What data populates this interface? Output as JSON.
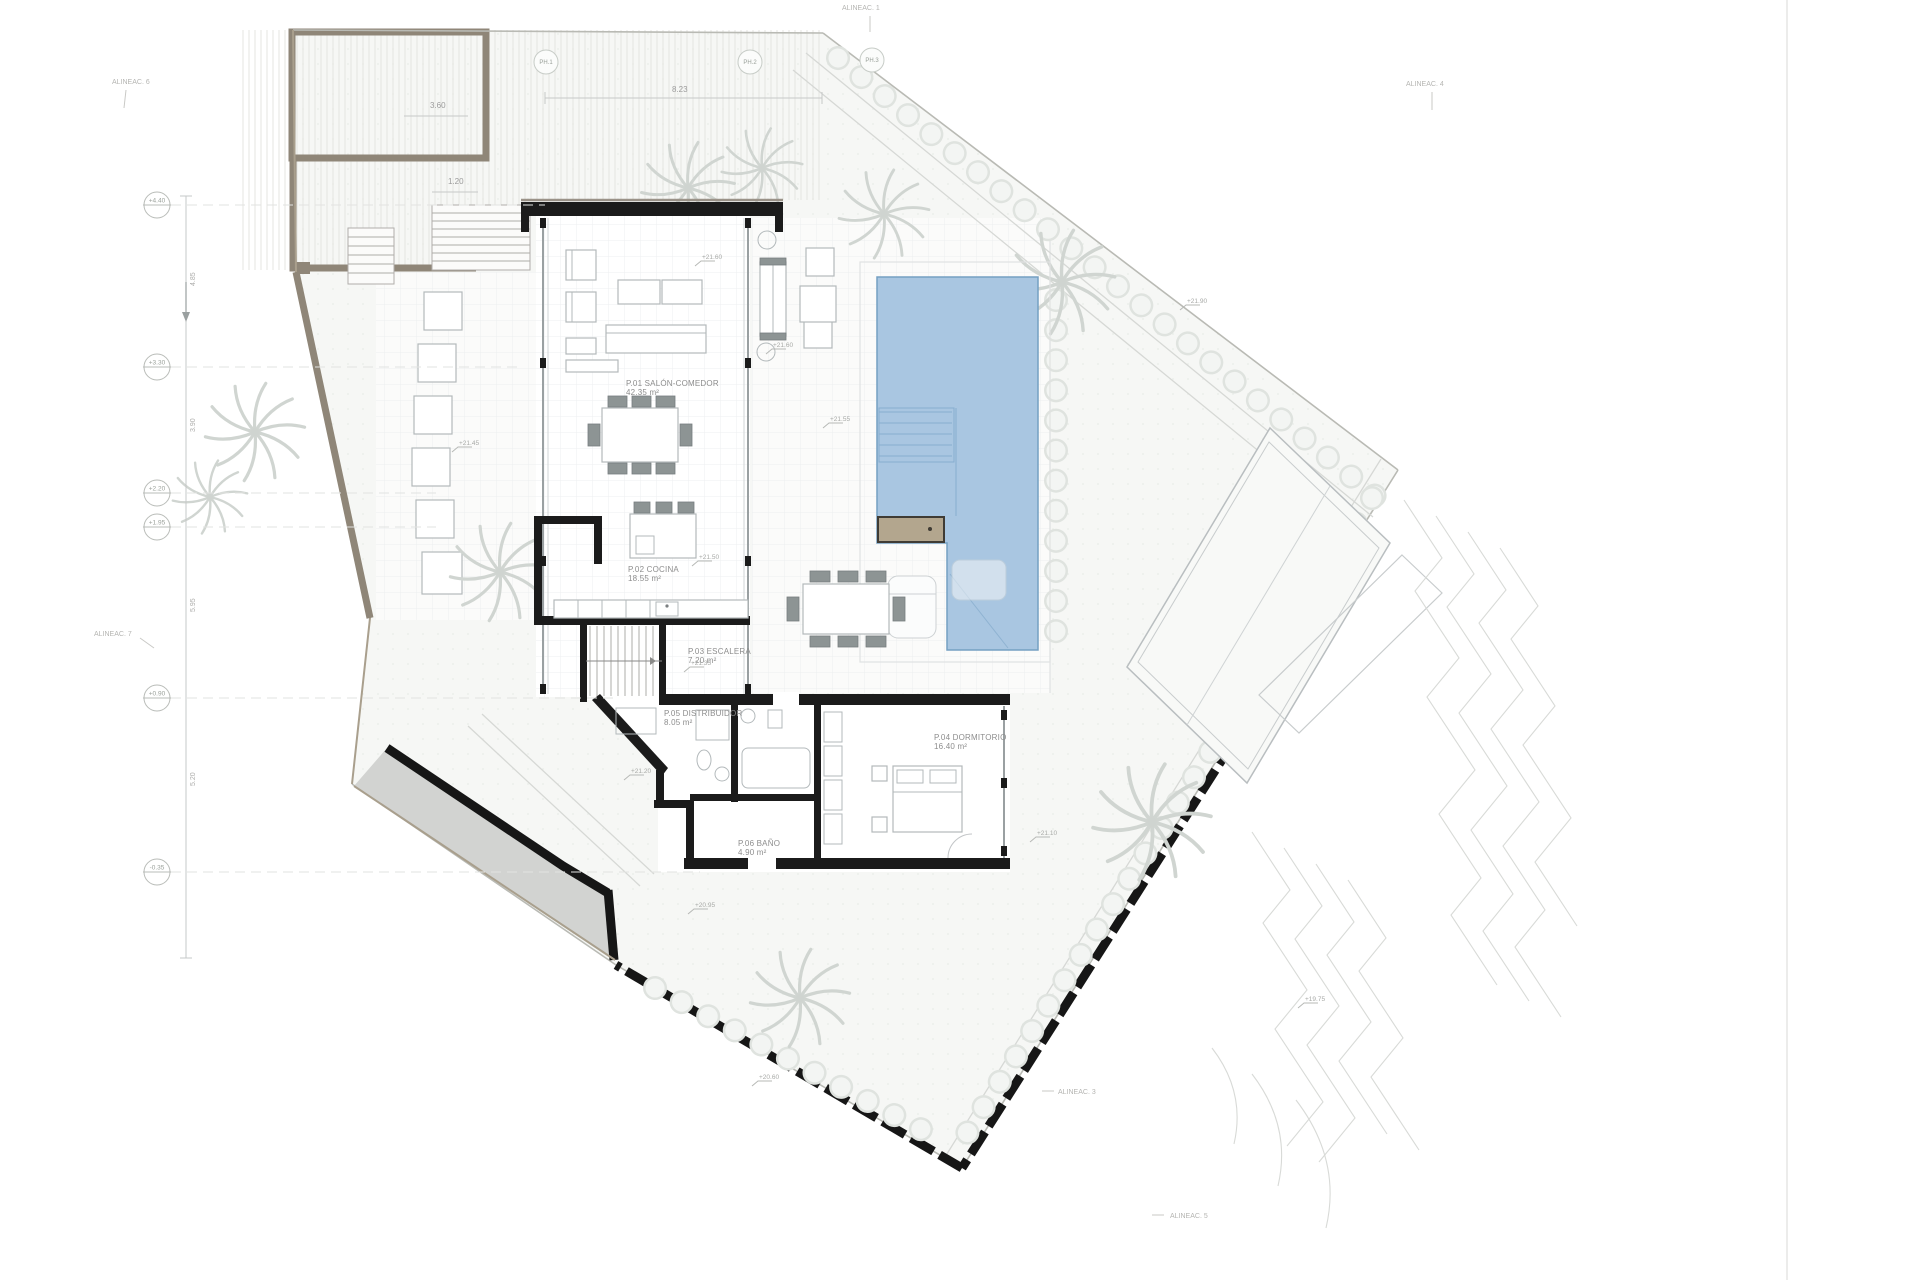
{
  "drawing": {
    "type": "villa ground-floor site plan",
    "sheet_edge_note": ""
  },
  "rooms": [
    {
      "id": "salon",
      "name": "P.01 SALÓN-COMEDOR",
      "area": "42.35 m²",
      "x": 626,
      "y": 386
    },
    {
      "id": "cocina",
      "name": "P.02 COCINA",
      "area": "18.55 m²",
      "x": 628,
      "y": 572
    },
    {
      "id": "escalera",
      "name": "P.03 ESCALERA",
      "area": "7.20 m²",
      "x": 688,
      "y": 654
    },
    {
      "id": "distribuidor",
      "name": "P.05 DISTRIBUIDOR",
      "area": "8.05 m²",
      "x": 664,
      "y": 716
    },
    {
      "id": "bano",
      "name": "P.06 BAÑO",
      "area": "4.90 m²",
      "x": 738,
      "y": 846
    },
    {
      "id": "dormitorio",
      "name": "P.04 DORMITORIO",
      "area": "16.40 m²",
      "x": 934,
      "y": 740
    }
  ],
  "alignment_labels": [
    {
      "text": "ALINEAC. 6",
      "x": 112,
      "y": 84,
      "tick": [
        14,
        6,
        12,
        24
      ]
    },
    {
      "text": "ALINEAC. 1",
      "x": 842,
      "y": 10,
      "tick": [
        28,
        6,
        28,
        22
      ]
    },
    {
      "text": "ALINEAC. 4",
      "x": 1406,
      "y": 86,
      "tick": [
        26,
        6,
        26,
        24
      ]
    },
    {
      "text": "ALINEAC. 7",
      "x": 94,
      "y": 636,
      "tick": [
        46,
        2,
        60,
        12
      ]
    },
    {
      "text": "ALINEAC. 3",
      "x": 1058,
      "y": 1094,
      "tick": [
        -16,
        -3,
        -4,
        -3
      ]
    },
    {
      "text": "ALINEAC. 5",
      "x": 1170,
      "y": 1218,
      "tick": [
        -18,
        -3,
        -6,
        -3
      ]
    }
  ],
  "plant_tags": [
    {
      "text": "PH.1",
      "x": 546,
      "y": 62
    },
    {
      "text": "PH.2",
      "x": 750,
      "y": 62
    },
    {
      "text": "PH.3",
      "x": 872,
      "y": 60
    }
  ],
  "datum_levels": [
    {
      "text": "+4.40",
      "y": 205,
      "lead": 545
    },
    {
      "text": "+3.30",
      "y": 367,
      "lead": 520
    },
    {
      "text": "+2.20",
      "y": 493,
      "lead": 436
    },
    {
      "text": "+1.95",
      "y": 527,
      "lead": 436
    },
    {
      "text": "+0.90",
      "y": 698,
      "lead": 615
    },
    {
      "text": "-0.35",
      "y": 872,
      "lead": 700
    }
  ],
  "spot_levels": [
    {
      "text": "+21.60",
      "x": 695,
      "y": 266
    },
    {
      "text": "+21.60",
      "x": 766,
      "y": 354
    },
    {
      "text": "+21.55",
      "x": 823,
      "y": 428
    },
    {
      "text": "+21.45",
      "x": 452,
      "y": 452
    },
    {
      "text": "+21.50",
      "x": 692,
      "y": 566
    },
    {
      "text": "+21.35",
      "x": 684,
      "y": 672
    },
    {
      "text": "+21.20",
      "x": 624,
      "y": 780
    },
    {
      "text": "+20.95",
      "x": 688,
      "y": 914
    },
    {
      "text": "+20.60",
      "x": 752,
      "y": 1086
    },
    {
      "text": "+21.10",
      "x": 1030,
      "y": 842
    },
    {
      "text": "+21.90",
      "x": 1180,
      "y": 310
    },
    {
      "text": "+19.75",
      "x": 1298,
      "y": 1008
    }
  ],
  "left_dim_ticks": [
    {
      "text": "4.85",
      "x": 195,
      "y": 286
    },
    {
      "text": "3.90",
      "x": 195,
      "y": 432
    },
    {
      "text": "5.95",
      "x": 195,
      "y": 612
    },
    {
      "text": "5.20",
      "x": 195,
      "y": 786
    }
  ],
  "dims": {
    "top": {
      "text": "8.23",
      "x": 672,
      "y": 92
    },
    "garage": {
      "text": "3.60",
      "x": 430,
      "y": 108
    },
    "court": {
      "text": "1.20",
      "x": 448,
      "y": 184
    }
  },
  "pool": {
    "water_color": "#a9c6e1",
    "edge_color": "#74a0c2",
    "bench_color": "#b3a68e",
    "step_count": 5
  },
  "colors": {
    "wall": "#1b1b1b",
    "tan_wall": "#8f8678",
    "ramp": "#d2d3d1",
    "garden": "#f6f7f5",
    "paving_grid": "#edeff0",
    "shrub": "#dfe3df",
    "palm": "#d0d5d1",
    "label": "#8d8d8d"
  }
}
